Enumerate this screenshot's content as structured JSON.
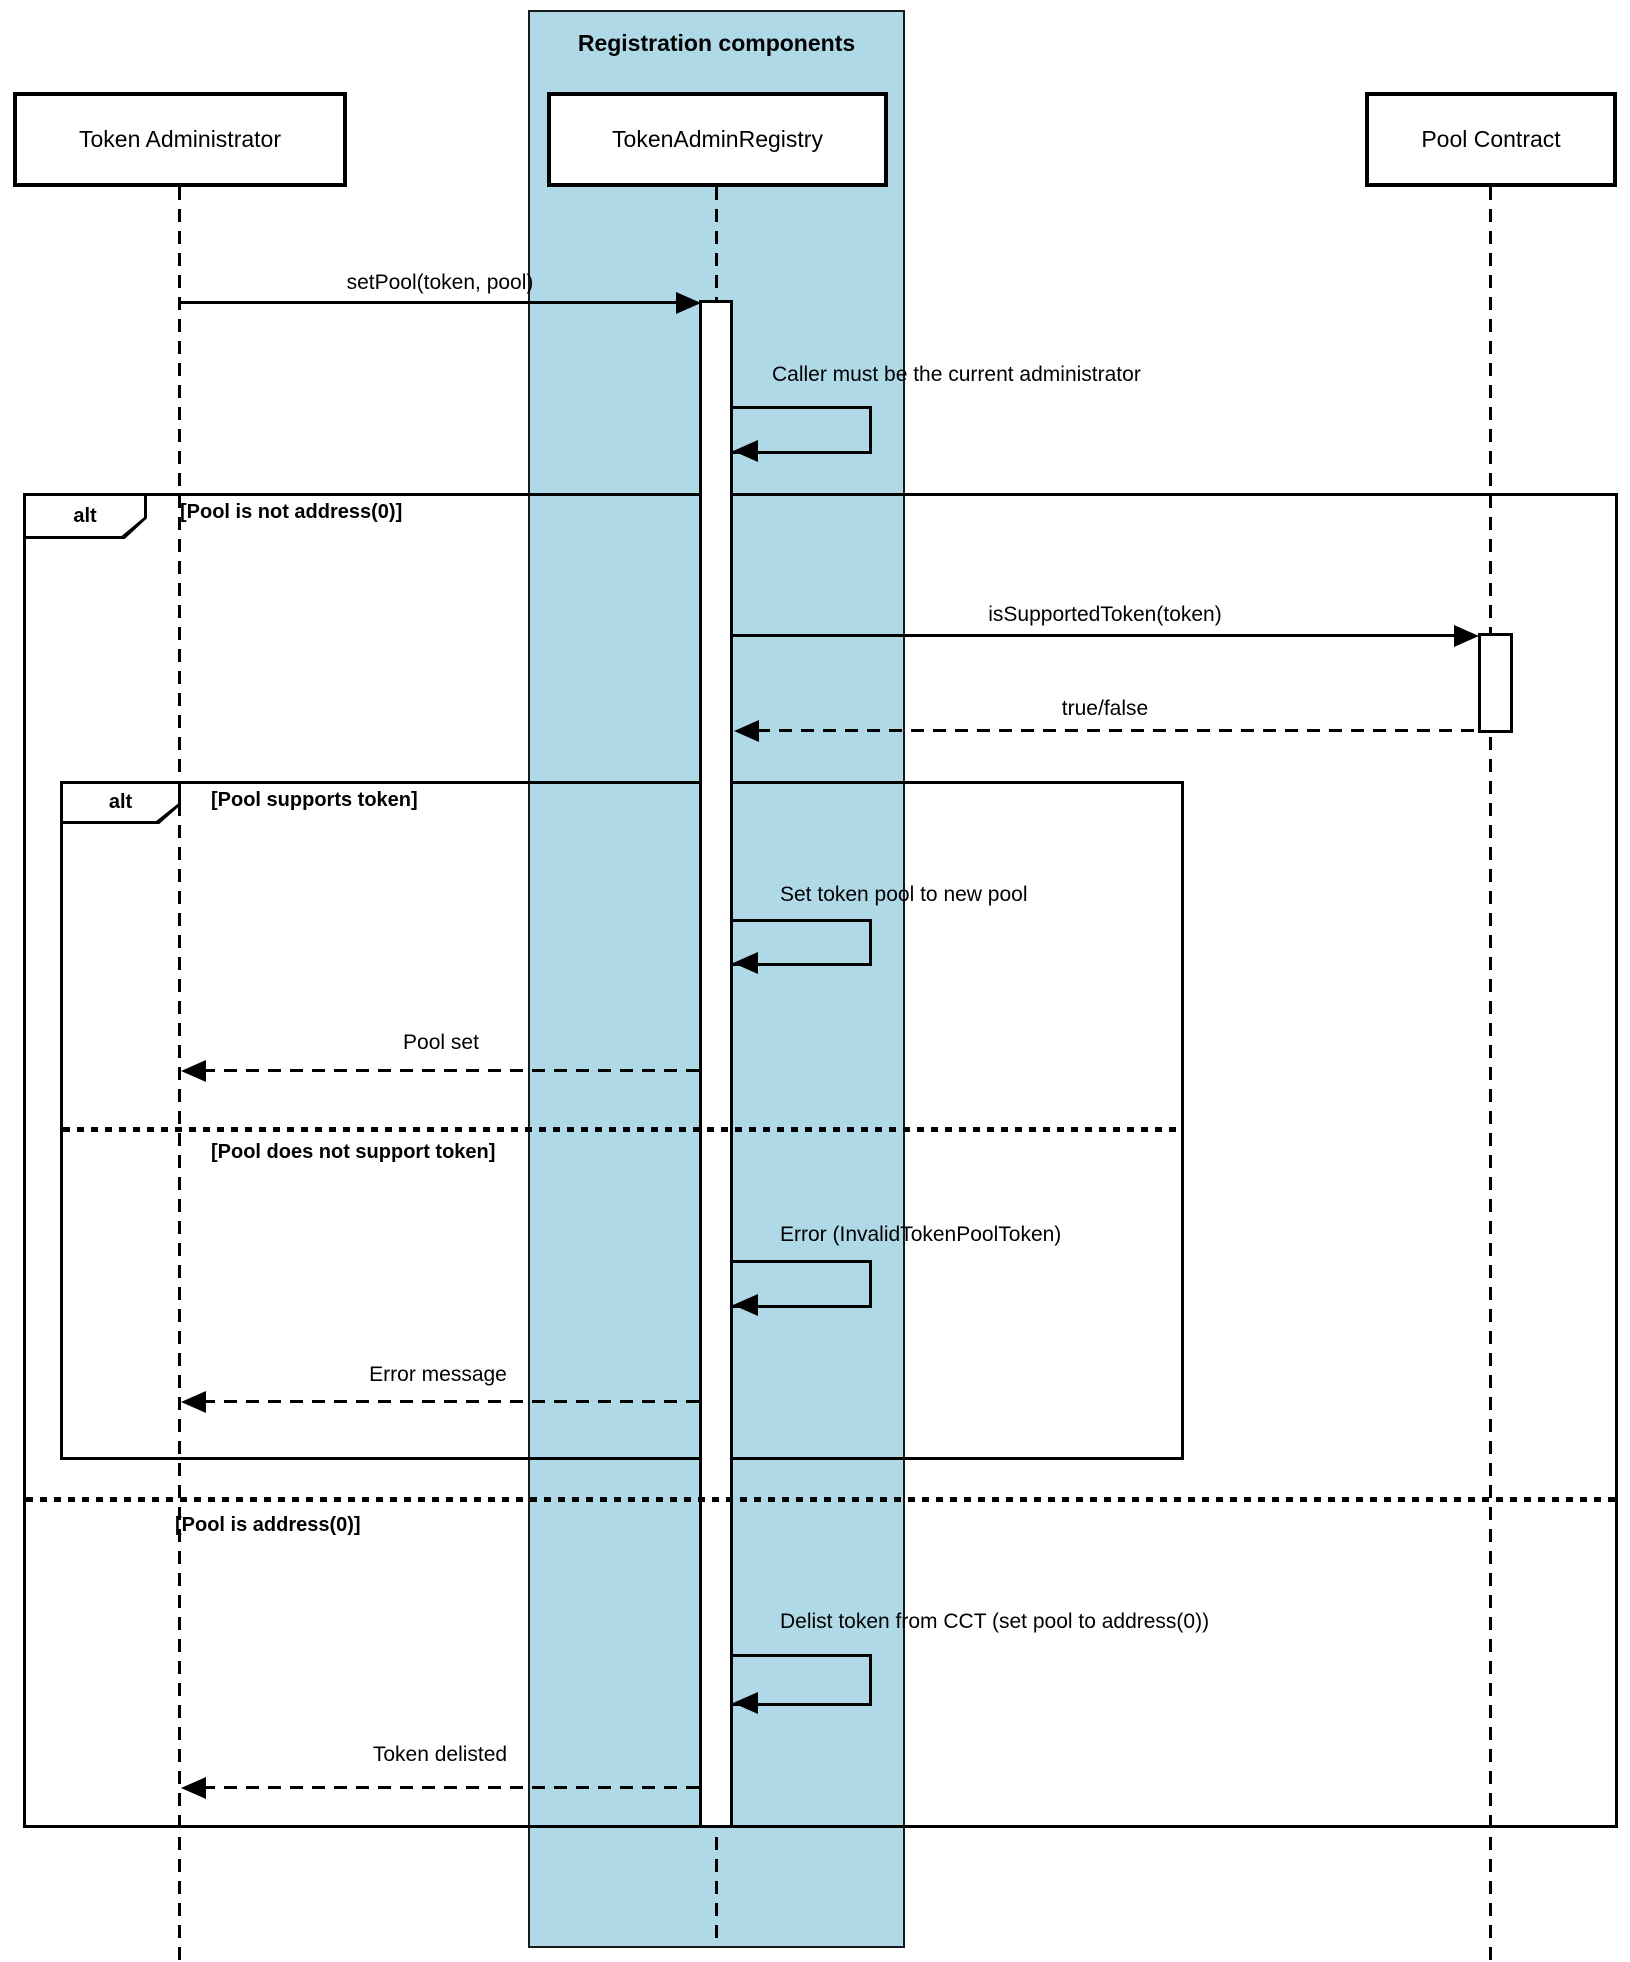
{
  "diagram": {
    "group": {
      "title": "Registration components"
    },
    "participants": [
      {
        "name": "Token Administrator"
      },
      {
        "name": "TokenAdminRegistry"
      },
      {
        "name": "Pool Contract"
      }
    ],
    "fragments": {
      "outer": {
        "operator": "alt",
        "guards": [
          "[Pool is not address(0)]",
          "[Pool is address(0)]"
        ]
      },
      "inner": {
        "operator": "alt",
        "guards": [
          "[Pool supports token]",
          "[Pool does not support token]"
        ]
      }
    },
    "messages": {
      "set_pool": "setPool(token, pool)",
      "caller_check": "Caller must be the current administrator",
      "is_supported": "isSupportedToken(token)",
      "true_false": "true/false",
      "set_token_pool": "Set token pool to new pool",
      "pool_set": "Pool set",
      "error_invalid": "Error (InvalidTokenPoolToken)",
      "error_message": "Error message",
      "delist": "Delist token from CCT (set pool to address(0))",
      "token_delisted": "Token delisted"
    },
    "colors": {
      "group_fill": "#B0D9E8",
      "line": "#000000",
      "background": "#FFFFFF"
    }
  }
}
